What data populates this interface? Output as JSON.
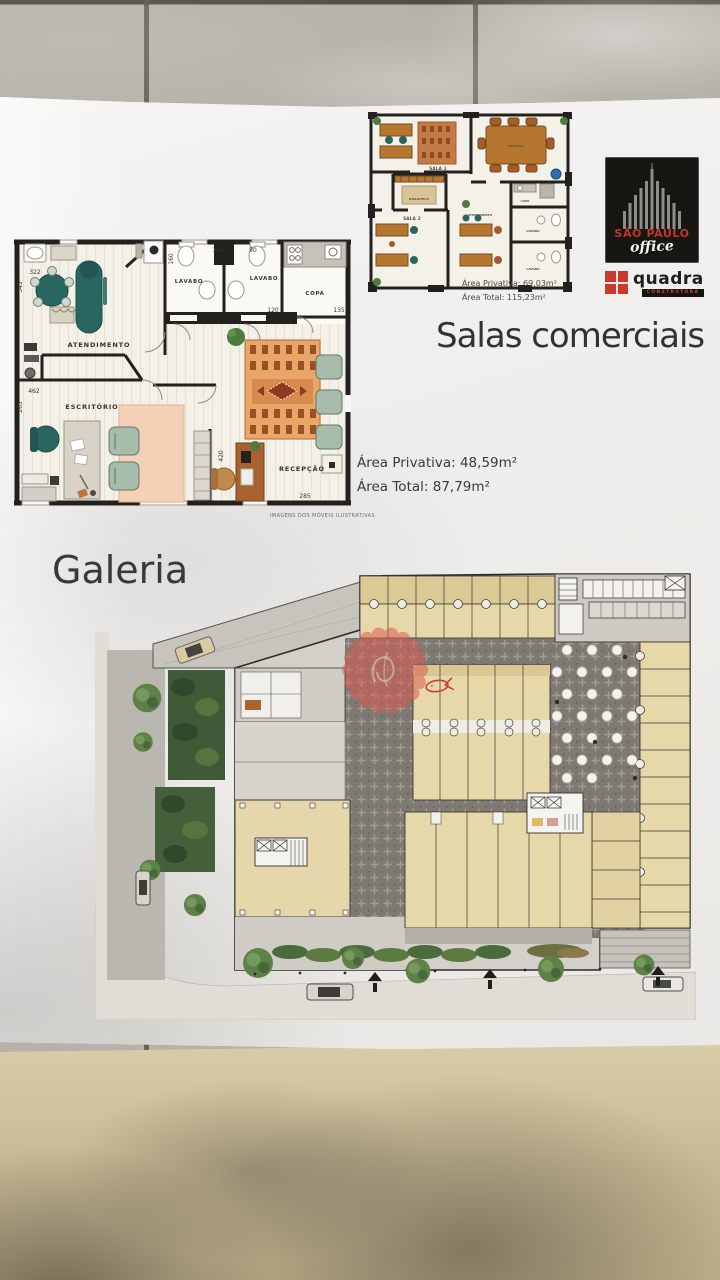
{
  "document": {
    "title": "Salas comerciais",
    "section_heading": "Galeria",
    "unit_area": {
      "privativa": "Área Privativa: 48,59m²",
      "total": "Área Total: 87,79m²"
    },
    "small_unit_area": {
      "privativa": "Área Privativa: 69,03m²",
      "total": "Área Total: 115,23m²"
    },
    "disclaimer": "IMAGENS DOS MÓVEIS ILUSTRATIVAS"
  },
  "brand": {
    "building_name_line1": "SÃO PAULO",
    "building_name_line2": "office",
    "builder_name": "quadra",
    "builder_tagline": "CONSTRUTORA"
  },
  "floor_plan": {
    "rooms": {
      "atendimento": "ATENDIMENTO",
      "escritorio": "ESCRITÓRIO",
      "lavabo_1": "LAVABO",
      "lavabo_2": "LAVABO",
      "copa": "COPA",
      "recepcao": "RECEPÇÃO"
    },
    "dimensions": {
      "d322": "322",
      "d345": "345",
      "d160": "160",
      "d120_top": "120",
      "d80": "80",
      "d120_mid": "120",
      "d135": "135",
      "d462": "462",
      "d265": "265",
      "d420": "420",
      "d285": "285"
    }
  },
  "small_floor_plan": {
    "rooms": {
      "sala1": "SALA 1",
      "reuniao": "REUNIÃO",
      "biblioteca": "BIBLIOTECA",
      "sala2": "SALA 2",
      "atendimento": "ATENDIMENTO",
      "copa": "COPA",
      "lavabo_1": "LAVABO",
      "lavabo_2": "LAVABO"
    }
  },
  "colors": {
    "accent_red": "#c4392b",
    "unit_tan": "#e7d8aa",
    "plaza_dark": "#7e7973",
    "furniture_teal": "#2a6660"
  }
}
